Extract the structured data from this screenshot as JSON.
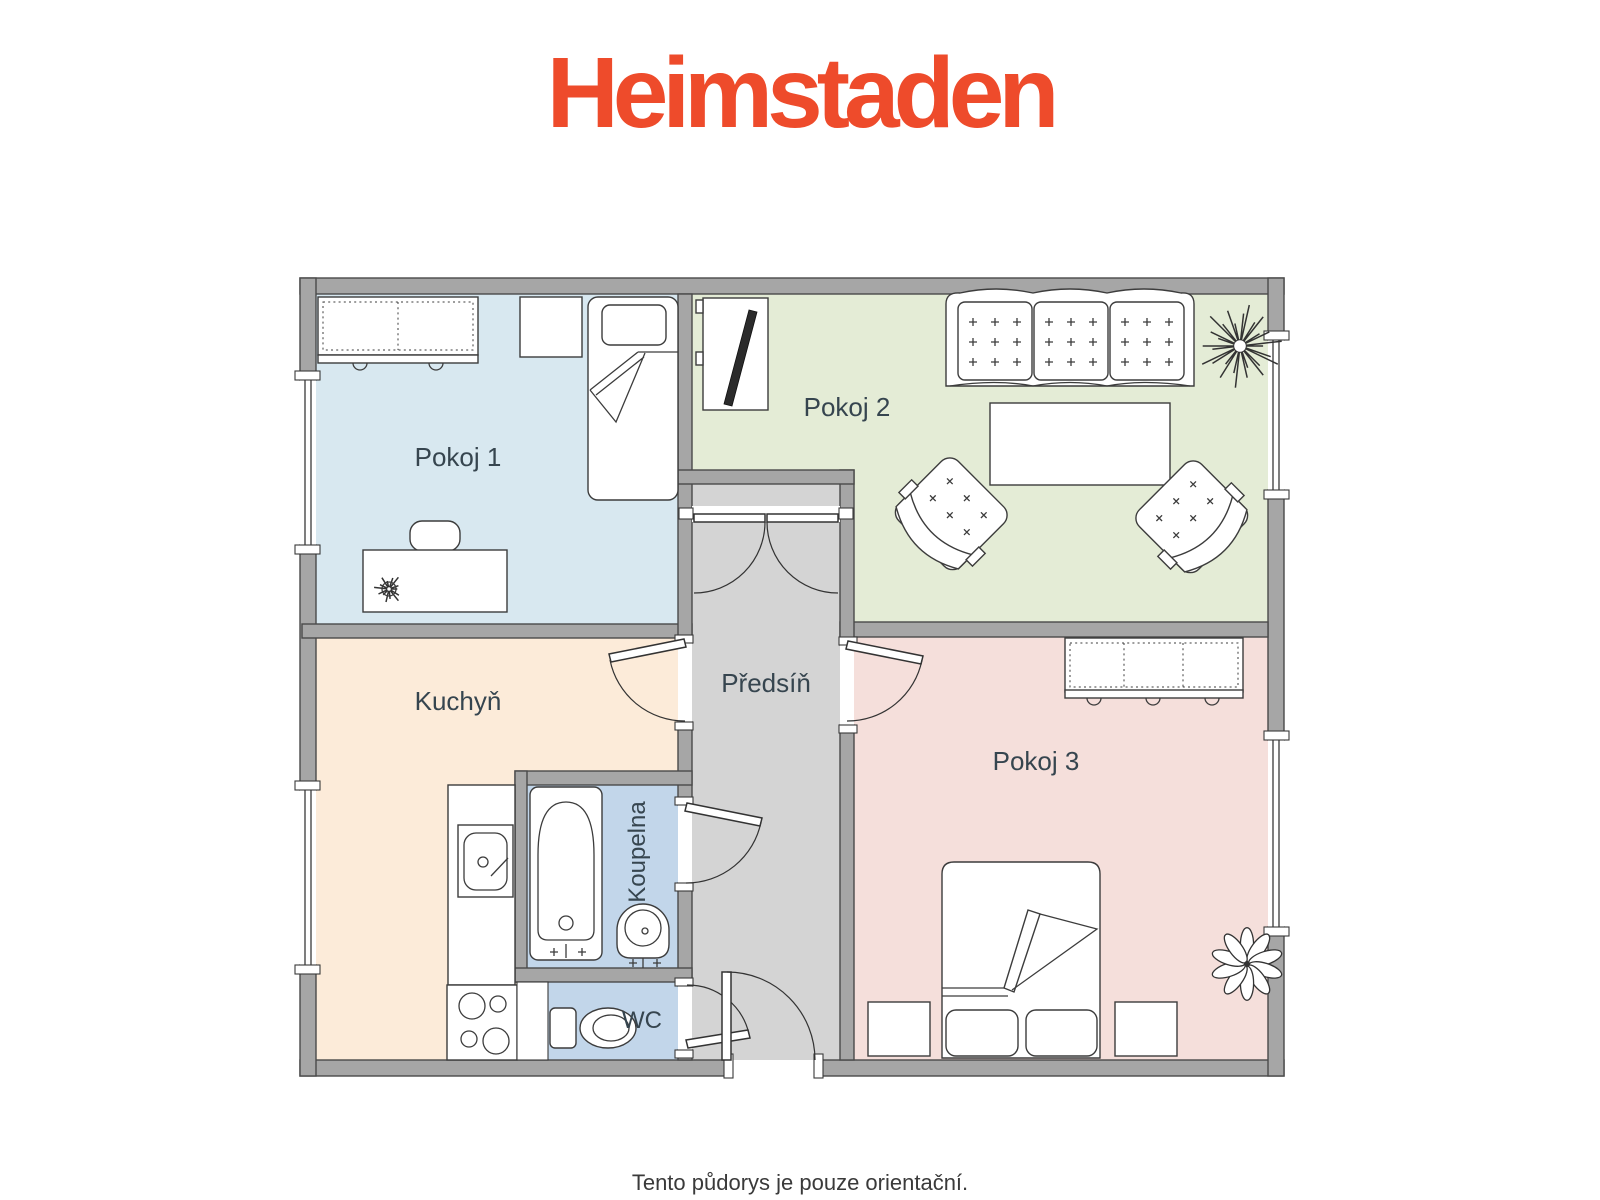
{
  "logo": {
    "text": "Heimstaden",
    "color": "#ee4b2b"
  },
  "plan": {
    "rooms": {
      "pokoj1": {
        "label": "Pokoj 1",
        "color": "#d8e8f0"
      },
      "pokoj2": {
        "label": "Pokoj 2",
        "color": "#e4ecd6"
      },
      "kuchyn": {
        "label": "Kuchyň",
        "color": "#fcebd9"
      },
      "predsin": {
        "label": "Předsíň",
        "color": "#d4d4d4"
      },
      "koupelna": {
        "label": "Koupelna",
        "color": "#c2d6ea"
      },
      "wc": {
        "label": "WC",
        "color": "#c2d6ea"
      },
      "pokoj3": {
        "label": "Pokoj 3",
        "color": "#f5dfdb"
      }
    },
    "label_color": "#36454f",
    "wall_color": "#a6a6a6"
  },
  "caption": {
    "text": "Tento půdorys je pouze orientační.",
    "color": "#3a3a3a"
  }
}
